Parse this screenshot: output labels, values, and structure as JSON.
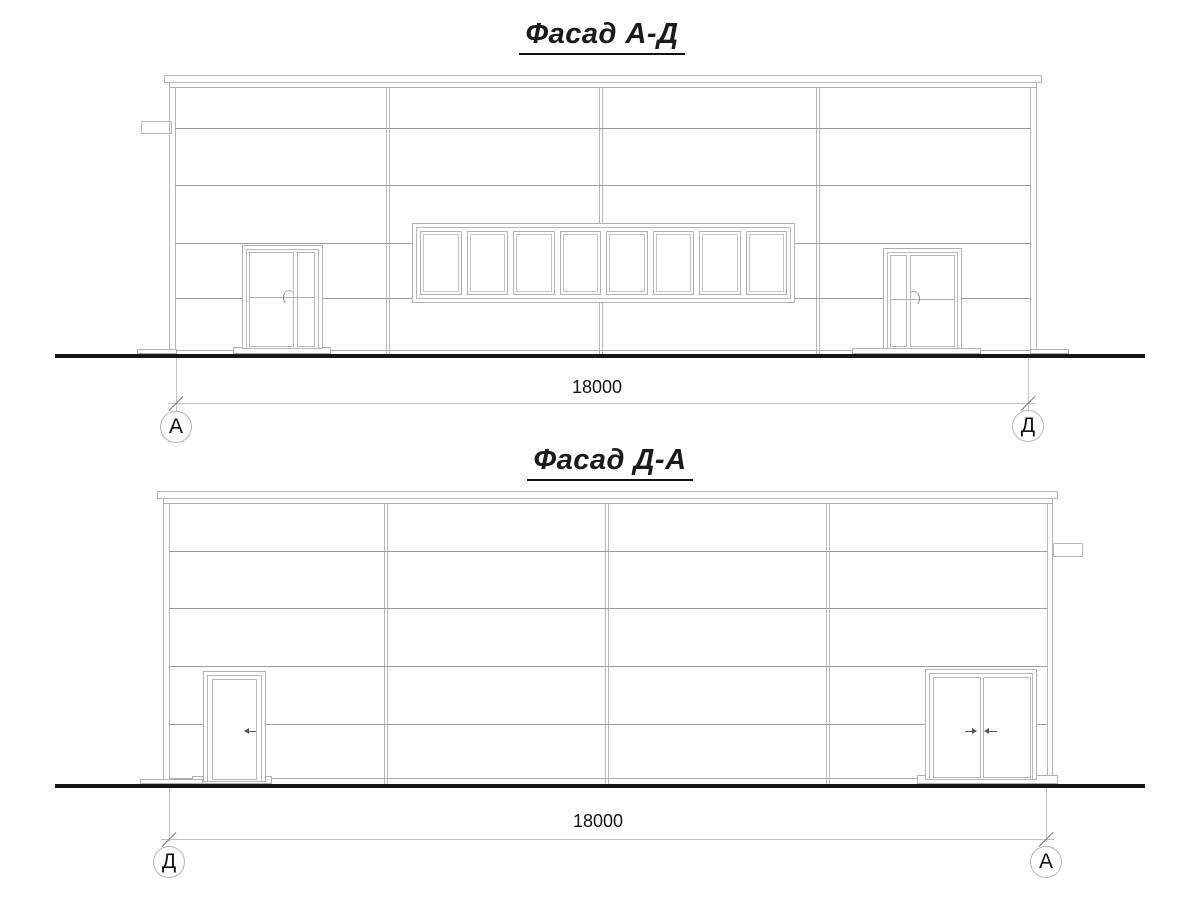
{
  "drawing": {
    "type": "architectural-elevation",
    "line_color": "#b0b0b0",
    "ground_color": "#161616",
    "text_color": "#1a1a1a"
  },
  "facades": [
    {
      "title": "Фасад А-Д",
      "bays": 4,
      "panel_rows": 4,
      "window_band": {
        "panes": 8
      },
      "doors": [
        "double-door-left",
        "double-door-right"
      ],
      "dimension": {
        "value": "18000",
        "left_axis": "А",
        "right_axis": "Д"
      }
    },
    {
      "title": "Фасад Д-А",
      "bays": 4,
      "panel_rows": 4,
      "window_band": {
        "panes": 0
      },
      "doors": [
        "single-door-left",
        "double-door-right"
      ],
      "dimension": {
        "value": "18000",
        "left_axis": "Д",
        "right_axis": "А"
      }
    }
  ]
}
